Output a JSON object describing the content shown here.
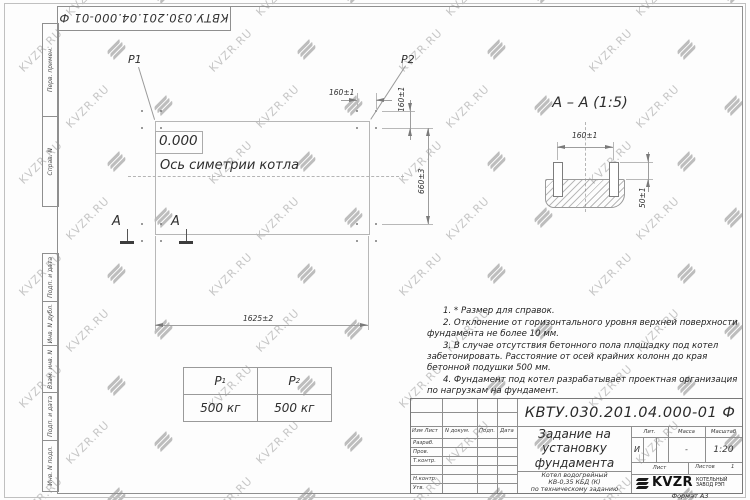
{
  "watermark": {
    "text": "KVZR.RU"
  },
  "frame": {
    "doc_number_top": "КВТУ.030.201.04.000-01 Ф",
    "side_labels": [
      "Перв. примен.",
      "Справ. N",
      "Подп. и дата",
      "Инв. N дубл.",
      "Взам. инв. N",
      "Подп. и дата",
      "Инв. N подл."
    ],
    "format_label": "Формат А3"
  },
  "plan": {
    "load1_label": "P1",
    "load2_label": "P2",
    "level_mark": "0.000",
    "axis_label": "Ось симетрии котла",
    "dim_length": "1625±2",
    "dim_height": "660±3",
    "dim_bolt_x": "160±1",
    "dim_bolt_y": "160±1",
    "section_letter_left": "А",
    "section_letter_right": "А"
  },
  "section_view": {
    "title": "А – А (1:5)",
    "dim_bolt_spacing": "160±1",
    "dim_bolt_height": "50±1"
  },
  "load_table": {
    "col1_header": "P",
    "col1_sub": "1",
    "col2_header": "P",
    "col2_sub": "2",
    "col1_value": "500 кг",
    "col2_value": "500 кг"
  },
  "notes": [
    "1. * Размер для справок.",
    "2. Отклонение от горизонтального уровня верхней поверхности фундамента не более 10 мм.",
    "3. В случае отсутствия бетонного пола площадку под котел забетонировать. Расстояние от осей крайних колонн до края бетонной подушки 500 мм.",
    "4. Фундамент под котел разрабатывает проектная организация по нагрузкам на фундамент."
  ],
  "title_block": {
    "doc_number": "КВТУ.030.201.04.000-01 Ф",
    "title": "Задание на установку фундамента",
    "subtitle_line1": "Котел водогрейный",
    "subtitle_line2": "КВ-0,35 КБД (К)",
    "subtitle_line3": "по техническому заданию",
    "col_headers": [
      "Изм Лист",
      "N докум.",
      "Подп.",
      "Дата"
    ],
    "row_labels": [
      "Разраб.",
      "Пров.",
      "Т.контр.",
      "Н.контр.",
      "Утв."
    ],
    "lit_header": "Лит.",
    "mass_header": "Масса",
    "scale_header": "Масштаб",
    "lit_value": "И",
    "mass_value": "-",
    "scale_value": "1:20",
    "sheet_label": "Лист",
    "sheets_label": "Листов",
    "sheets_value": "1",
    "company_name": "KVZR",
    "company_desc_line1": "КОТЕЛЬНЫЙ",
    "company_desc_line2": "ЗАВОД РЭП"
  }
}
